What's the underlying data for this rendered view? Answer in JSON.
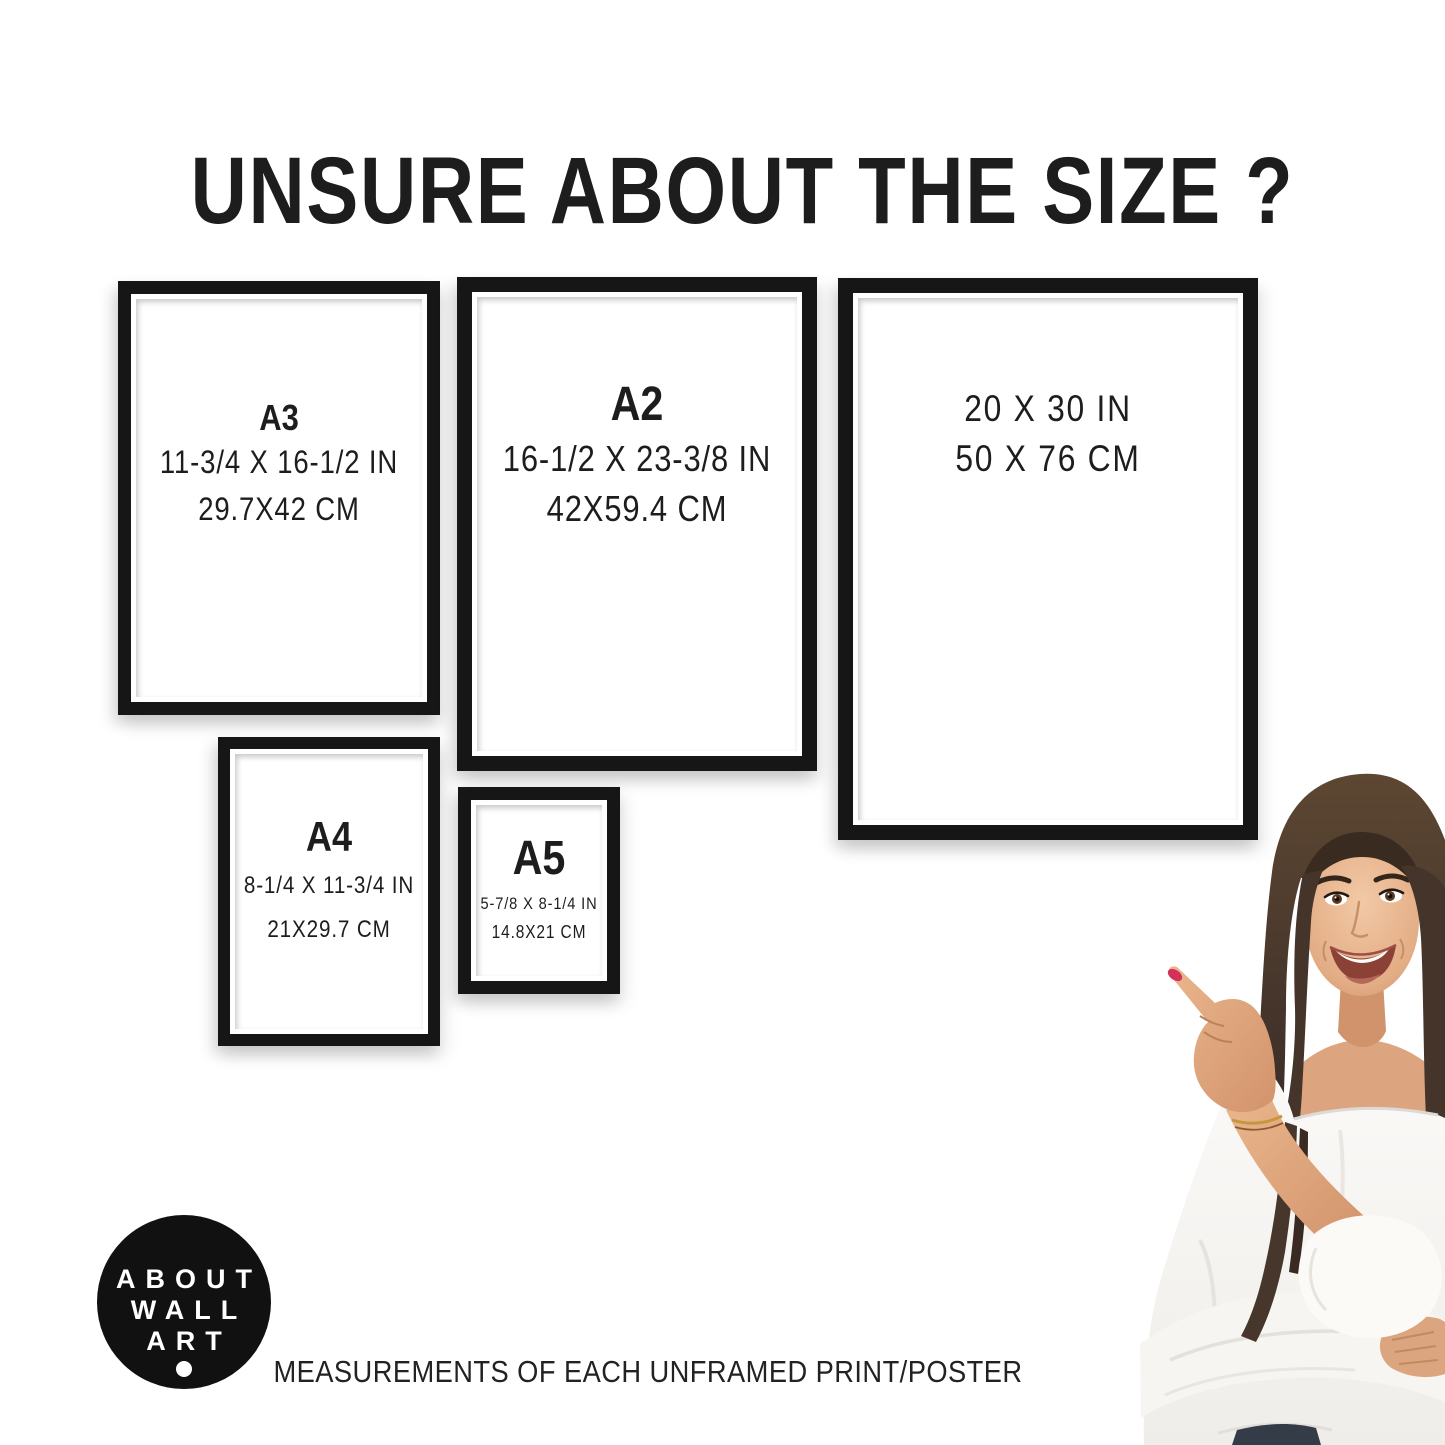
{
  "title": "UNSURE ABOUT THE SIZE ?",
  "frames": [
    {
      "name": "A3",
      "inches": "11-3/4 X 16-1/2 IN",
      "cm": "29.7X42 CM"
    },
    {
      "name": "A2",
      "inches": "16-1/2 X 23-3/8 IN",
      "cm": "42X59.4 CM"
    },
    {
      "inches": "20 X 30 IN",
      "cm": "50 X 76 CM"
    },
    {
      "name": "A4",
      "inches": "8-1/4 X 11-3/4 IN",
      "cm": "21X29.7 CM"
    },
    {
      "name": "A5",
      "inches": "5-7/8 X 8-1/4 IN",
      "cm": "14.8X21 CM"
    }
  ],
  "logo": {
    "lines": [
      "ABOUT",
      "WALL",
      "ART"
    ]
  },
  "footer": "MEASUREMENTS OF EACH UNFRAMED PRINT/POSTER",
  "colors": {
    "frame": "#161616",
    "ink": "#1d1d1d",
    "bg": "#ffffff",
    "logoBg": "#111111",
    "logoText": "#ffffff",
    "nail": "#d4305a"
  }
}
